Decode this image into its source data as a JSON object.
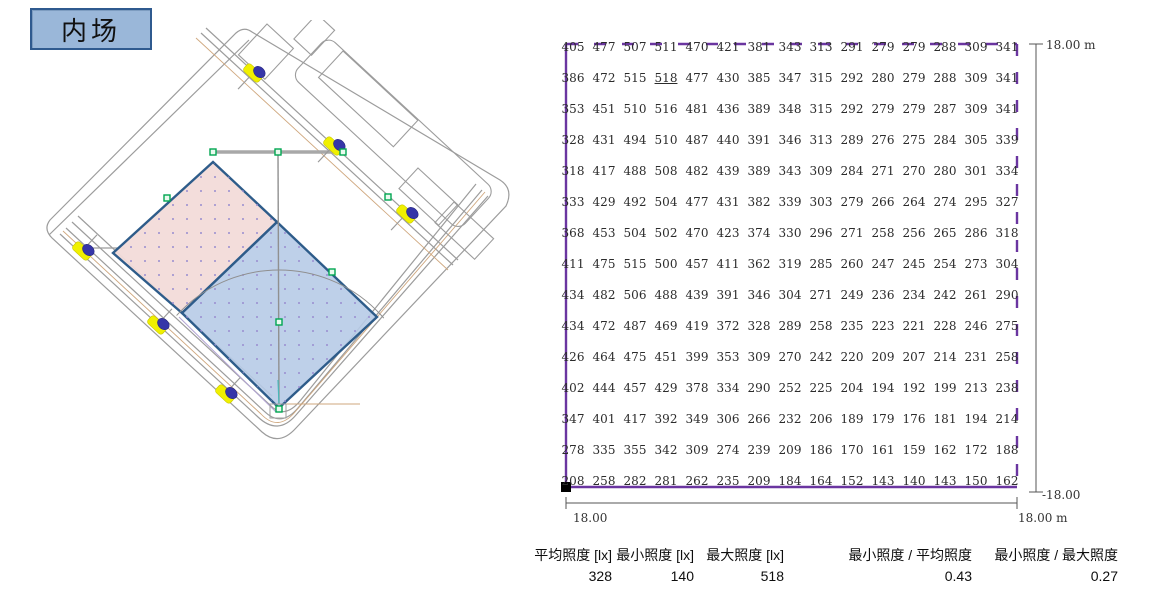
{
  "title_box": {
    "label": "内场"
  },
  "chart_data": {
    "type": "heatmap",
    "title": "内场",
    "unit": "lx",
    "grid_rows": 15,
    "grid_cols": 15,
    "grid_values_lx": [
      [
        405,
        477,
        507,
        511,
        470,
        421,
        381,
        343,
        313,
        291,
        279,
        279,
        288,
        309,
        341
      ],
      [
        386,
        472,
        515,
        518,
        477,
        430,
        385,
        347,
        315,
        292,
        280,
        279,
        288,
        309,
        341
      ],
      [
        353,
        451,
        510,
        516,
        481,
        436,
        389,
        348,
        315,
        292,
        279,
        279,
        287,
        309,
        341
      ],
      [
        328,
        431,
        494,
        510,
        487,
        440,
        391,
        346,
        313,
        289,
        276,
        275,
        284,
        305,
        339
      ],
      [
        318,
        417,
        488,
        508,
        482,
        439,
        389,
        343,
        309,
        284,
        271,
        270,
        280,
        301,
        334
      ],
      [
        333,
        429,
        492,
        504,
        477,
        431,
        382,
        339,
        303,
        279,
        266,
        264,
        274,
        295,
        327
      ],
      [
        368,
        453,
        504,
        502,
        470,
        423,
        374,
        330,
        296,
        271,
        258,
        256,
        265,
        286,
        318
      ],
      [
        411,
        475,
        515,
        500,
        457,
        411,
        362,
        319,
        285,
        260,
        247,
        245,
        254,
        273,
        304
      ],
      [
        434,
        482,
        506,
        488,
        439,
        391,
        346,
        304,
        271,
        249,
        236,
        234,
        242,
        261,
        290
      ],
      [
        434,
        472,
        487,
        469,
        419,
        372,
        328,
        289,
        258,
        235,
        223,
        221,
        228,
        246,
        275
      ],
      [
        426,
        464,
        475,
        451,
        399,
        353,
        309,
        270,
        242,
        220,
        209,
        207,
        214,
        231,
        258
      ],
      [
        402,
        444,
        457,
        429,
        378,
        334,
        290,
        252,
        225,
        204,
        194,
        192,
        199,
        213,
        238
      ],
      [
        347,
        401,
        417,
        392,
        349,
        306,
        266,
        232,
        206,
        189,
        179,
        176,
        181,
        194,
        214
      ],
      [
        278,
        335,
        355,
        342,
        309,
        274,
        239,
        209,
        186,
        170,
        161,
        159,
        162,
        172,
        188
      ],
      [
        208,
        258,
        282,
        281,
        262,
        235,
        209,
        184,
        164,
        152,
        143,
        140,
        143,
        150,
        162
      ]
    ],
    "underlined_max_value": 518,
    "axis_extent_m": [
      -18,
      18
    ],
    "summary": {
      "average_lx": 328,
      "min_lx": 140,
      "max_lx": 518,
      "min_over_avg": 0.43,
      "min_over_max": 0.27
    }
  },
  "dimensions": {
    "right_top": "18.00 m",
    "right_bottom": "-18.00",
    "bottom_left": "18.00",
    "bottom_right": "18.00 m"
  },
  "stats": {
    "items": [
      {
        "label": "平均照度 [lx]",
        "value": "328"
      },
      {
        "label": "最小照度 [lx]",
        "value": "140"
      },
      {
        "label": "最大照度 [lx]",
        "value": "518"
      },
      {
        "label": "最小照度 / 平均照度",
        "value": "0.43"
      },
      {
        "label": "最小照度 / 最大照度",
        "value": "0.27"
      }
    ]
  },
  "site_plan": {
    "floodlight_count": 6,
    "areas": [
      {
        "id": "pink-area",
        "color": "#f2dbd9"
      },
      {
        "id": "blue-area",
        "color": "#b7cbe7"
      }
    ]
  },
  "colors": {
    "grid_border_purple": "#6a35a0",
    "dimension_line": "#555555",
    "field_border_blue": "#2e5c8a",
    "light_yellow": "#f0f000",
    "light_head_blue": "#3636a8",
    "node_green": "#00a651",
    "title_fill": "#9ab7d9",
    "title_border": "#2f5a8f"
  }
}
